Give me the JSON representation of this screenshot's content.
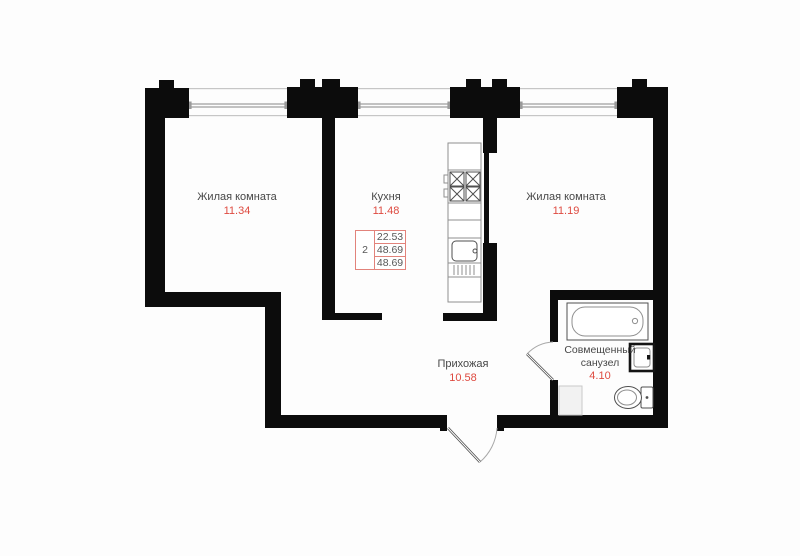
{
  "rooms": [
    {
      "name": "Жилая комната",
      "area": "11.34"
    },
    {
      "name": "Кухня",
      "area": "11.48"
    },
    {
      "name": "Жилая комната",
      "area": "11.19"
    },
    {
      "name": "Прихожая",
      "area": "10.58"
    },
    {
      "name": "Совмещенный санузел",
      "area": "4.10"
    }
  ],
  "stamp": {
    "rooms_count": "2",
    "living_area": "22.53",
    "total_area": "48.69",
    "total_area_with_balcony": "48.69"
  },
  "icons": [
    "stove-icon",
    "kitchen-sink-icon",
    "bathtub-icon",
    "washbasin-icon",
    "toilet-icon",
    "ventilation-shaft",
    "entrance-door-icon",
    "bathroom-door-icon",
    "window"
  ],
  "colors": {
    "wall": "#0c0c0c",
    "bg": "#fdfdfd",
    "label_text": "#474747",
    "accent_red": "#de4a40",
    "stamp_border": "#e2837b",
    "stamp_text": "#575757"
  }
}
